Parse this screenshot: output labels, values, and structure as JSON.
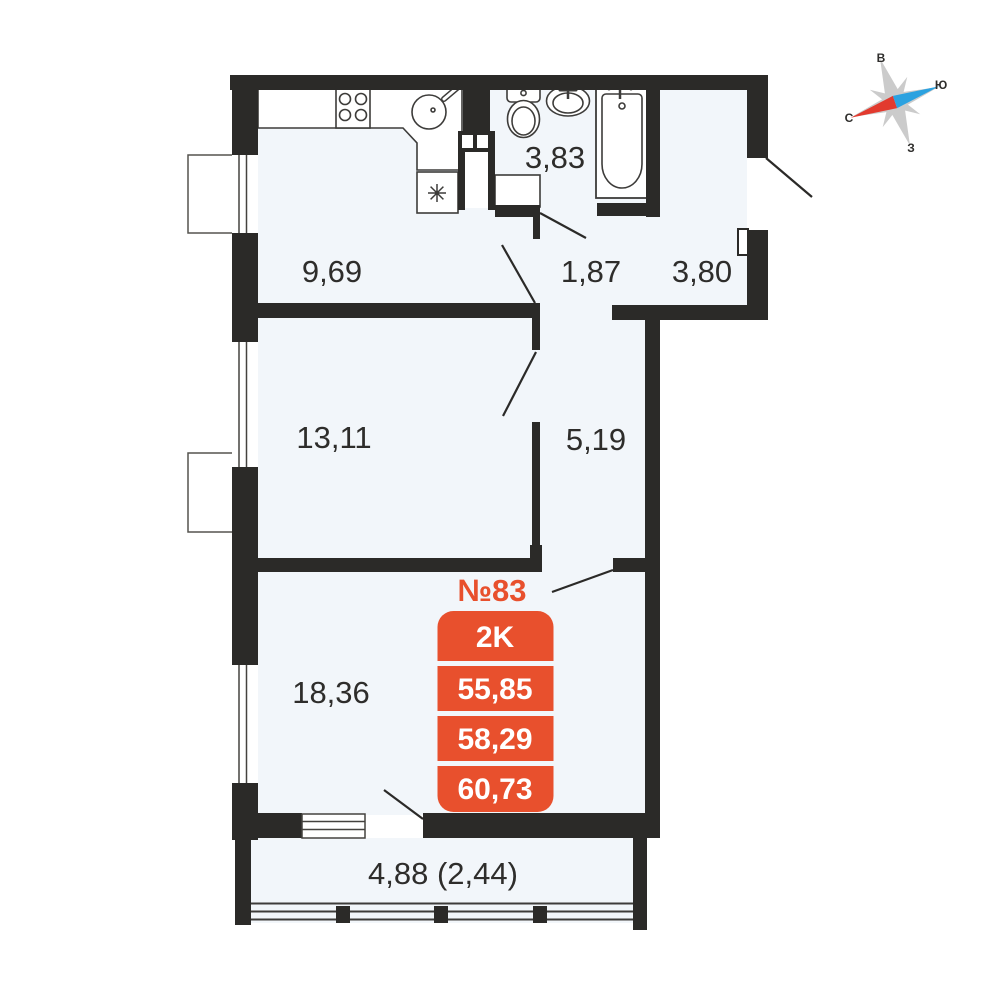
{
  "floor_plan": {
    "unit_label": "№83",
    "info_card": {
      "rooms_type": "2K",
      "area_1": "55,85",
      "area_2": "58,29",
      "area_3": "60,73"
    },
    "rooms": {
      "kitchen": "9,69",
      "bathroom": "3,83",
      "hall": "1,87",
      "entry_hall": "3,80",
      "bedroom": "13,11",
      "corridor": "5,19",
      "living_room": "18,36",
      "balcony": "4,88 (2,44)"
    },
    "compass": {
      "east": "В",
      "south": "Ю",
      "north": "С",
      "west": "З"
    },
    "colors": {
      "accent": "#e8502d",
      "wall": "#2b2a28",
      "floor": "#f2f6fa",
      "compass_red": "#e23a2e",
      "compass_blue": "#2ca2e0",
      "compass_gray": "#cbcbcb"
    }
  }
}
